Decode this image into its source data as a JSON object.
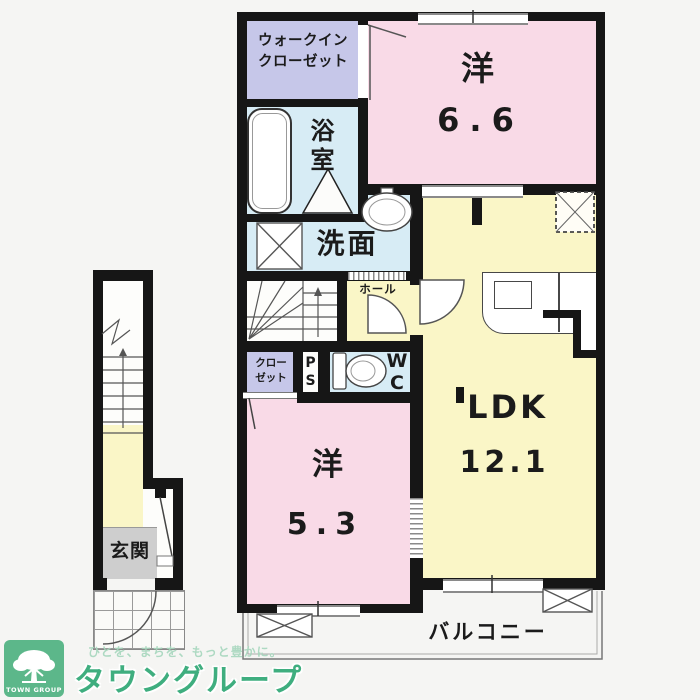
{
  "colors": {
    "bg": "#f5f5f3",
    "wall": "#161616",
    "room-pink": "#f9dae7",
    "room-yellow": "#faf6c7",
    "room-lavender": "#c6c7e9",
    "room-blue": "#d7ecf5",
    "entry-gray": "#cecece",
    "logo-green": "#5cb78a",
    "brand-green": "#3fae7f",
    "tagline-green": "#a6d7bd"
  },
  "branding": {
    "logo_text": "TOWN GROUP",
    "tagline": "ひとを、まちを、もっと豊かに。",
    "company": "タウングループ"
  },
  "plan": {
    "rooms": {
      "walk_in_closet": {
        "line1": "ウォークイン",
        "line2": "クローゼット"
      },
      "bathroom": {
        "label": "浴室"
      },
      "washroom": {
        "label": "洗面"
      },
      "hall": {
        "label": "ホール"
      },
      "closet": {
        "line1": "クロー",
        "line2": "ゼット"
      },
      "pipe_space": {
        "line1": "P",
        "line2": "S"
      },
      "toilet": {
        "line1": "W",
        "line2": "C"
      },
      "western_room_66": {
        "type": "洋",
        "area": "6.6"
      },
      "western_room_53": {
        "type": "洋",
        "area": "5.3"
      },
      "ldk": {
        "type": "LDK",
        "area": "12.1"
      },
      "entrance": {
        "label": "玄関"
      },
      "balcony": {
        "label": "バルコニー"
      }
    }
  }
}
